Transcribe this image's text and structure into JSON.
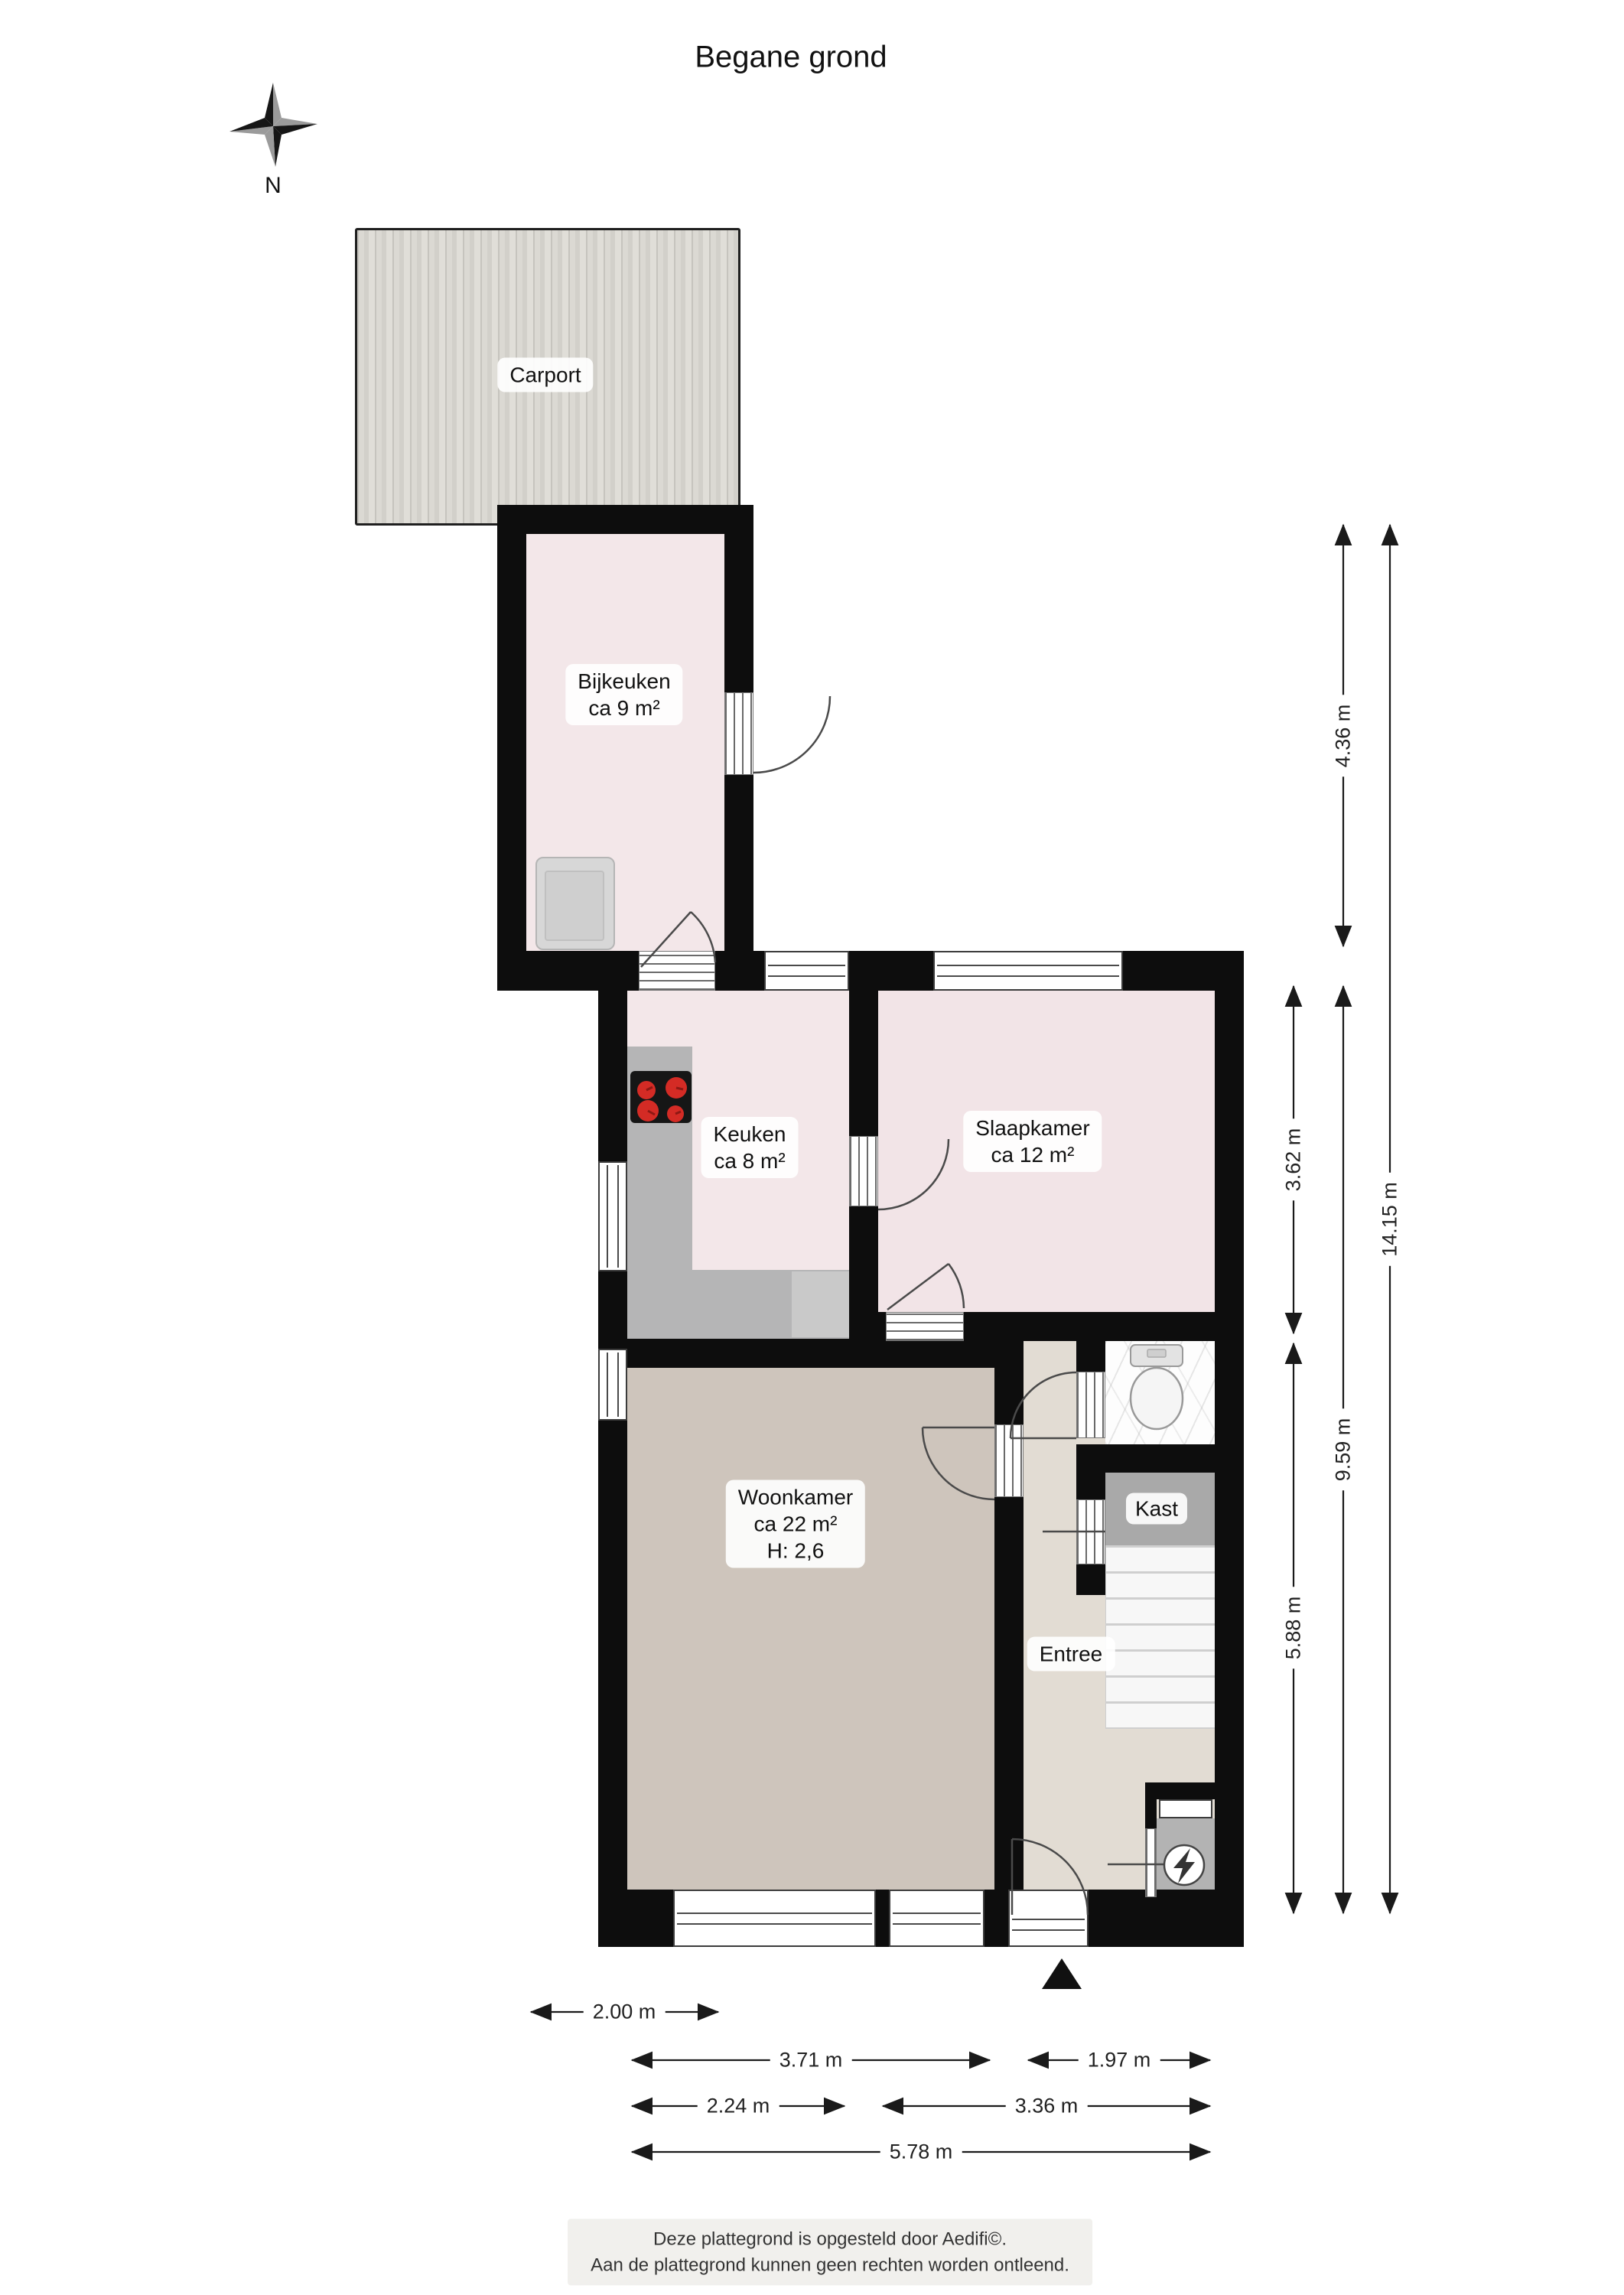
{
  "title": "Begane grond",
  "compass": {
    "north_label": "N"
  },
  "rooms": {
    "carport": {
      "name": "Carport"
    },
    "bijkeuken": {
      "name": "Bijkeuken",
      "area": "ca 9 m²"
    },
    "keuken": {
      "name": "Keuken",
      "area": "ca 8 m²"
    },
    "slaapkamer": {
      "name": "Slaapkamer",
      "area": "ca 12 m²"
    },
    "woonkamer": {
      "name": "Woonkamer",
      "area": "ca 22 m²",
      "ceiling_height": "H: 2,6"
    },
    "entree": {
      "name": "Entree"
    },
    "kast": {
      "name": "Kast"
    }
  },
  "dimensions": {
    "v_bijkeuken": {
      "label": "4.36 m"
    },
    "v_keuken_slaapkamer": {
      "label": "3.62 m"
    },
    "v_main": {
      "label": "9.59 m"
    },
    "v_woonkamer": {
      "label": "5.88 m"
    },
    "v_total": {
      "label": "14.15 m"
    },
    "h_bijkeuken": {
      "label": "2.00 m"
    },
    "h_woonkamer": {
      "label": "3.71 m"
    },
    "h_entree": {
      "label": "1.97 m"
    },
    "h_keuken": {
      "label": "2.24 m"
    },
    "h_slaapkamer": {
      "label": "3.36 m"
    },
    "h_total": {
      "label": "5.78 m"
    }
  },
  "footer": {
    "line1": "Deze plattegrond is opgesteld door Aedifi©.",
    "line2": "Aan de plattegrond kunnen geen rechten worden ontleend."
  },
  "colors": {
    "wall": "#0d0d0d",
    "room_pink": "#f3e7e9",
    "slaapkamer_pink": "#f2e4e7",
    "woonkamer_floor": "#cec5bc",
    "entree_floor": "#e2dcd3",
    "kast_gray": "#a9a9a9",
    "counter_gray": "#b5b5b6",
    "carport_gray": "#d8d6d0",
    "burner_red": "#d42b25"
  }
}
